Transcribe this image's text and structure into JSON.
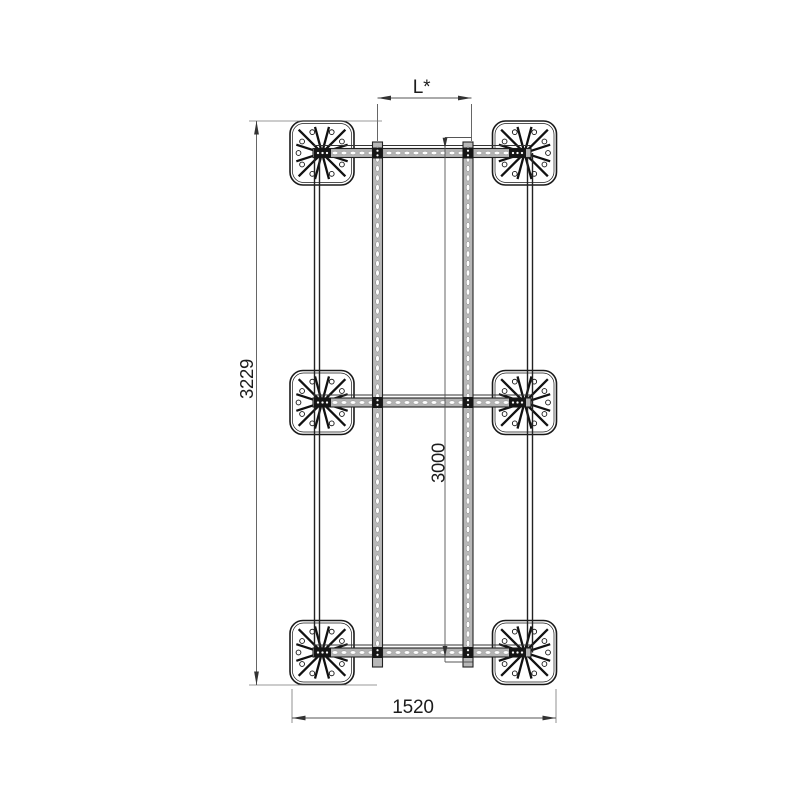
{
  "drawing": {
    "type": "technical-top-view-frame",
    "dimensions": {
      "module_spacing": {
        "label": "L*"
      },
      "total_height": {
        "label": "3229"
      },
      "rail_length": {
        "label": "3000"
      },
      "base_width": {
        "label": "1520"
      }
    },
    "colors": {
      "line": "#1a1a1a",
      "metal_gray": "#b3b3b3",
      "dim_line": "#555555",
      "background": "#ffffff"
    }
  }
}
